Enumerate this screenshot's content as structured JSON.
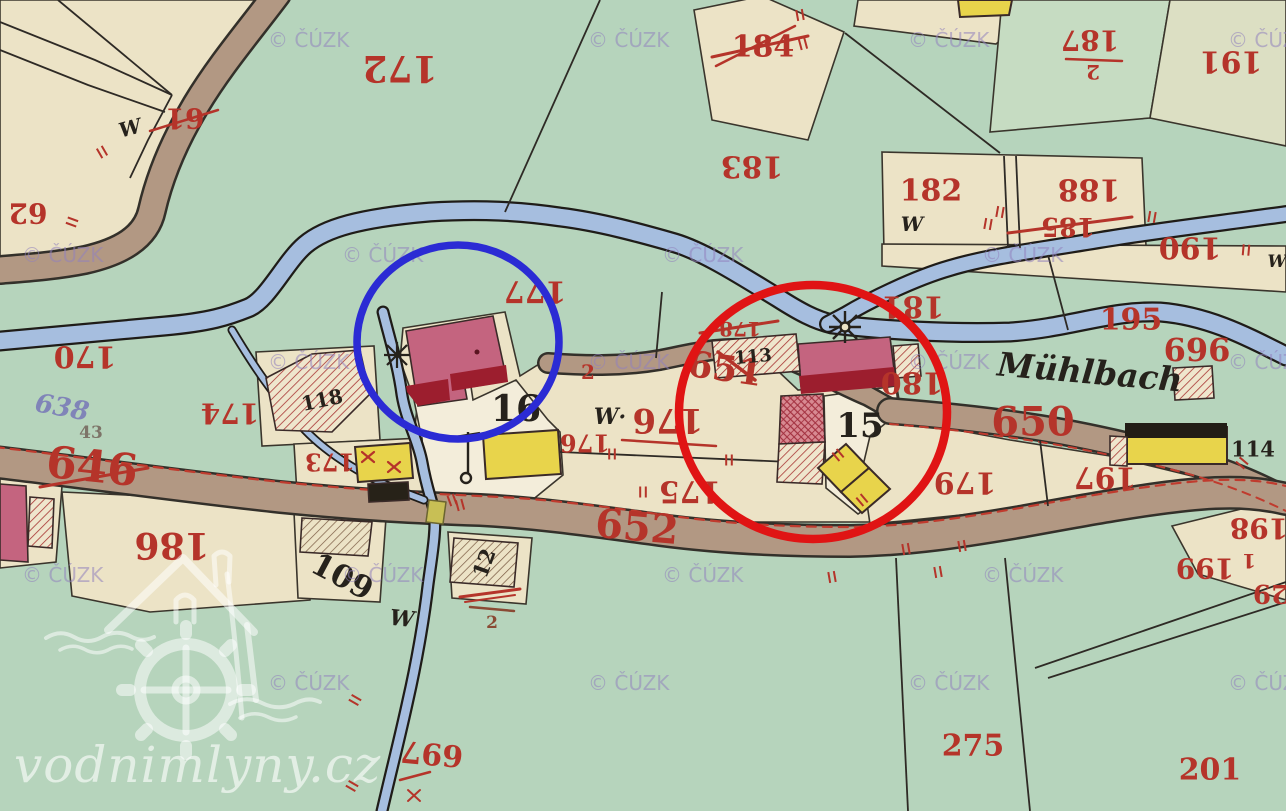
{
  "map": {
    "watermark_text": "© ČÚZK",
    "logo": {
      "text": "vodnimlyny.cz",
      "color": "rgba(255,255,255,0.62)"
    },
    "stream_name": "Mühlbach",
    "colors": {
      "background": "#b6d4bc",
      "parcel_cream": "#ece3c6",
      "parcel_white": "#f3edda",
      "road_brown": "#b29883",
      "stream_blue": "#a6bedf",
      "masonry_pink": "#c4647f",
      "masonry_dark": "#9c1e2e",
      "wood_yellow": "#e8d44b",
      "ink_red": "#b5342a",
      "ink_black": "#26221c",
      "ink_gray": "#7d7468",
      "ink_slate": "#8084b8",
      "ink_sepia": "#8a4a34",
      "watermark": "rgba(145,130,190,0.55)",
      "blue_annotation": "#2b2bd4",
      "red_annotation": "#e01414"
    },
    "annotations": {
      "blue_circle": {
        "cx": 458,
        "cy": 342,
        "rx": 101,
        "ry": 97,
        "width": 7.5
      },
      "red_circle": {
        "cx": 813,
        "cy": 412,
        "rx": 134,
        "ry": 127,
        "width": 8.5
      }
    },
    "labels": [
      {
        "t": "172",
        "x": 400,
        "y": 68,
        "s": 36,
        "r": 180
      },
      {
        "t": "184",
        "x": 763,
        "y": 47,
        "s": 30
      },
      {
        "t": "187",
        "x": 1090,
        "y": 40,
        "s": 28,
        "r": 180
      },
      {
        "t": "2",
        "x": 1093,
        "y": 72,
        "s": 20,
        "r": 180
      },
      {
        "t": "191",
        "x": 1231,
        "y": 61,
        "s": 30,
        "r": 180
      },
      {
        "t": "61",
        "x": 185,
        "y": 118,
        "s": 28,
        "r": 180
      },
      {
        "t": "62",
        "x": 28,
        "y": 213,
        "s": 28,
        "r": 180
      },
      {
        "t": "183",
        "x": 752,
        "y": 166,
        "s": 30,
        "r": 180
      },
      {
        "t": "182",
        "x": 931,
        "y": 191,
        "s": 30
      },
      {
        "t": "188",
        "x": 1089,
        "y": 189,
        "s": 30,
        "r": 180
      },
      {
        "t": "185",
        "x": 1068,
        "y": 226,
        "s": 26,
        "r": 180
      },
      {
        "t": "190",
        "x": 1190,
        "y": 247,
        "s": 30,
        "r": 180
      },
      {
        "t": "170",
        "x": 85,
        "y": 356,
        "s": 30,
        "r": 180
      },
      {
        "t": "177",
        "x": 535,
        "y": 291,
        "s": 30,
        "r": 180
      },
      {
        "t": "181",
        "x": 913,
        "y": 306,
        "s": 30,
        "r": 180
      },
      {
        "t": "195",
        "x": 1131,
        "y": 320,
        "s": 30
      },
      {
        "t": "696",
        "x": 1197,
        "y": 350,
        "s": 32
      },
      {
        "t": "180",
        "x": 912,
        "y": 382,
        "s": 30,
        "r": 180
      },
      {
        "t": "638",
        "x": 62,
        "y": 408,
        "s": 26,
        "r": 10,
        "c": "slate",
        "i": true
      },
      {
        "t": "43",
        "x": 91,
        "y": 433,
        "s": 17,
        "c": "gray"
      },
      {
        "t": "646",
        "x": 92,
        "y": 467,
        "s": 44,
        "r": 6
      },
      {
        "t": "174",
        "x": 230,
        "y": 413,
        "s": 28,
        "r": 180
      },
      {
        "t": "178",
        "x": 740,
        "y": 329,
        "s": 20,
        "r": 180
      },
      {
        "t": "651",
        "x": 725,
        "y": 369,
        "s": 36,
        "r": 8
      },
      {
        "t": "2",
        "x": 588,
        "y": 372,
        "s": 20
      },
      {
        "t": "176",
        "x": 585,
        "y": 443,
        "s": 24,
        "r": 180
      },
      {
        "t": "176",
        "x": 668,
        "y": 420,
        "s": 34,
        "r": 180
      },
      {
        "t": "175",
        "x": 690,
        "y": 491,
        "s": 30,
        "r": 180
      },
      {
        "t": "179",
        "x": 965,
        "y": 482,
        "s": 30,
        "r": 180
      },
      {
        "t": "650",
        "x": 1033,
        "y": 422,
        "s": 40
      },
      {
        "t": "197",
        "x": 1105,
        "y": 477,
        "s": 30,
        "r": 180
      },
      {
        "t": "652",
        "x": 637,
        "y": 527,
        "s": 40,
        "r": 5
      },
      {
        "t": "173",
        "x": 330,
        "y": 462,
        "s": 24,
        "r": 180
      },
      {
        "t": "186",
        "x": 172,
        "y": 545,
        "s": 36,
        "r": 180
      },
      {
        "t": "199",
        "x": 1205,
        "y": 568,
        "s": 28,
        "r": 180
      },
      {
        "t": "1",
        "x": 1249,
        "y": 561,
        "s": 20,
        "r": 180
      },
      {
        "t": "198",
        "x": 1259,
        "y": 528,
        "s": 28,
        "r": 180
      },
      {
        "t": "29",
        "x": 1271,
        "y": 593,
        "s": 26,
        "r": 180
      },
      {
        "t": "275",
        "x": 973,
        "y": 746,
        "s": 30
      },
      {
        "t": "201",
        "x": 1210,
        "y": 770,
        "s": 30
      },
      {
        "t": "697",
        "x": 432,
        "y": 753,
        "s": 30,
        "r": 185
      },
      {
        "t": "W",
        "x": 130,
        "y": 128,
        "s": 20,
        "r": -15,
        "c": "black",
        "i": true
      },
      {
        "t": "W",
        "x": 912,
        "y": 224,
        "s": 20,
        "c": "black",
        "i": true
      },
      {
        "t": "W",
        "x": 1277,
        "y": 262,
        "s": 17,
        "c": "black",
        "i": true
      },
      {
        "t": "W·",
        "x": 610,
        "y": 417,
        "s": 22,
        "c": "black",
        "i": true
      },
      {
        "t": "W",
        "x": 402,
        "y": 619,
        "s": 22,
        "r": 6,
        "c": "black",
        "i": true
      },
      {
        "t": "16",
        "x": 516,
        "y": 409,
        "s": 36,
        "c": "black"
      },
      {
        "t": "15",
        "x": 860,
        "y": 426,
        "s": 34,
        "c": "black"
      },
      {
        "t": "118",
        "x": 322,
        "y": 400,
        "s": 20,
        "r": -12,
        "c": "black"
      },
      {
        "t": "113",
        "x": 753,
        "y": 357,
        "s": 18,
        "r": -5,
        "c": "black"
      },
      {
        "t": "114",
        "x": 1253,
        "y": 449,
        "s": 21,
        "c": "black"
      },
      {
        "t": "109",
        "x": 342,
        "y": 577,
        "s": 31,
        "r": 28,
        "c": "black"
      },
      {
        "t": "12",
        "x": 484,
        "y": 563,
        "s": 21,
        "r": -70,
        "c": "black"
      },
      {
        "t": "Mühlbach",
        "x": 1090,
        "y": 372,
        "s": 33,
        "r": 5,
        "c": "black",
        "i": true
      },
      {
        "t": "2",
        "x": 492,
        "y": 623,
        "s": 17,
        "c": "sepia"
      }
    ],
    "strokes": [
      [
        712,
        57,
        808,
        36,
        3
      ],
      [
        716,
        66,
        795,
        26,
        2.5
      ],
      [
        1008,
        233,
        1132,
        217,
        3
      ],
      [
        150,
        131,
        218,
        110,
        2.5
      ],
      [
        1066,
        59,
        1122,
        61,
        2.5
      ],
      [
        622,
        440,
        716,
        446,
        2.5
      ],
      [
        700,
        333,
        778,
        321,
        3
      ],
      [
        718,
        352,
        755,
        380,
        3.5
      ],
      [
        40,
        487,
        148,
        468,
        3
      ],
      [
        460,
        597,
        520,
        589,
        3
      ],
      [
        465,
        602,
        515,
        595,
        2
      ],
      [
        400,
        780,
        430,
        772,
        2.5
      ],
      [
        470,
        607,
        514,
        611,
        2.5,
        "sepia"
      ],
      [
        408,
        790,
        420,
        801,
        2
      ],
      [
        420,
        790,
        408,
        801,
        2
      ],
      [
        362,
        452,
        374,
        462,
        2.2
      ],
      [
        374,
        452,
        362,
        462,
        2.2
      ],
      [
        388,
        462,
        400,
        472,
        2.2
      ],
      [
        400,
        462,
        388,
        472,
        2.2
      ]
    ],
    "fence_marks": [
      [
        102,
        152,
        60
      ],
      [
        72,
        222,
        20
      ],
      [
        800,
        15,
        80
      ],
      [
        803,
        44,
        75
      ],
      [
        1152,
        217,
        100
      ],
      [
        1246,
        250,
        95
      ],
      [
        1000,
        212,
        100
      ],
      [
        988,
        224,
        100
      ],
      [
        612,
        454,
        90
      ],
      [
        729,
        460,
        90
      ],
      [
        643,
        492,
        90
      ],
      [
        452,
        500,
        70
      ],
      [
        906,
        549,
        80
      ],
      [
        962,
        546,
        80
      ],
      [
        1242,
        463,
        40
      ],
      [
        838,
        455,
        50
      ],
      [
        862,
        500,
        50
      ],
      [
        355,
        700,
        30
      ],
      [
        352,
        786,
        30
      ],
      [
        832,
        577,
        80
      ],
      [
        938,
        572,
        80
      ],
      [
        460,
        505,
        75
      ]
    ],
    "watermarks": [
      [
        268,
        47
      ],
      [
        588,
        47
      ],
      [
        908,
        47
      ],
      [
        1228,
        47
      ],
      [
        22,
        262
      ],
      [
        342,
        262
      ],
      [
        662,
        262
      ],
      [
        982,
        262
      ],
      [
        268,
        369
      ],
      [
        588,
        369
      ],
      [
        908,
        369
      ],
      [
        1228,
        369
      ],
      [
        22,
        582
      ],
      [
        342,
        582
      ],
      [
        662,
        582
      ],
      [
        982,
        582
      ],
      [
        268,
        690
      ],
      [
        588,
        690
      ],
      [
        908,
        690
      ],
      [
        1228,
        690
      ]
    ]
  }
}
